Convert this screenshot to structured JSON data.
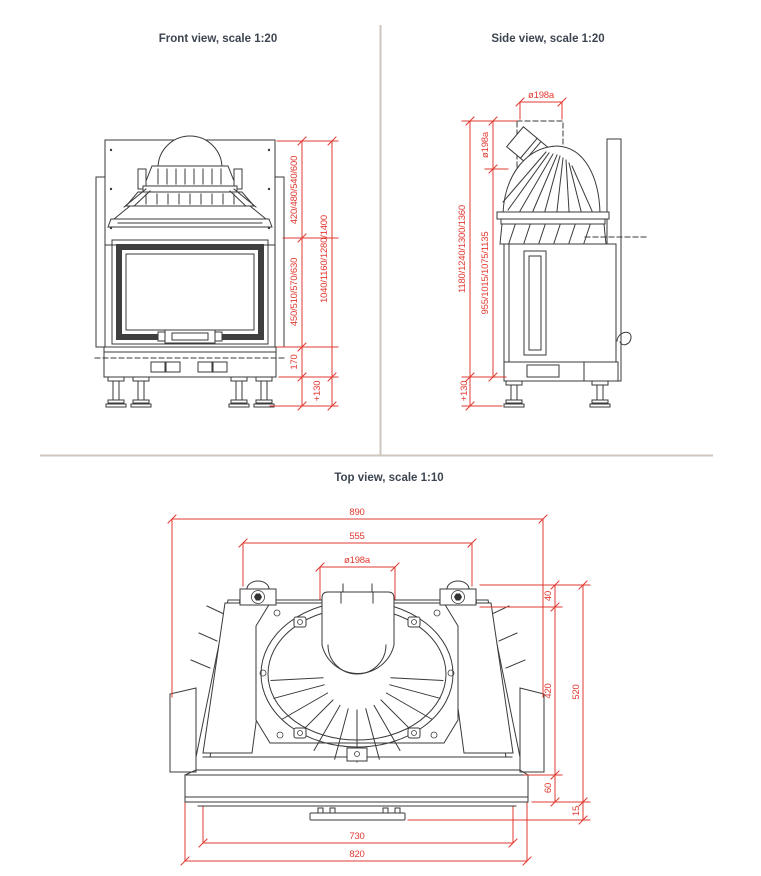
{
  "colors": {
    "dimension_red": "#e23a32",
    "drawing_line": "#3a3a3a",
    "title_text": "#3d4551",
    "divider": "#cdc6bf",
    "background": "#ffffff"
  },
  "front_view": {
    "title": "Front view, scale 1:20",
    "dims": {
      "hood_height": "420/480/540/600",
      "door_height": "450/510/570/630",
      "base_height": "170",
      "total_height": "1040/1160/1280/1400",
      "leg_height": "+130"
    }
  },
  "side_view": {
    "title": "Side view, scale 1:20",
    "dims": {
      "flue_diameter_top": "ø198a",
      "flue_diameter_side": "ø198a",
      "total_height": "1180/1240/1300/1360",
      "body_height": "955/1015/1075/1135",
      "leg_height": "+130"
    }
  },
  "top_view": {
    "title": "Top view, scale 1:10",
    "dims": {
      "overall_width": "890",
      "bracket_span": "555",
      "flue_diameter": "ø198a",
      "rear_depth": "40",
      "mid_depth": "420",
      "total_depth": "520",
      "front_depth": "60",
      "lip_depth": "15",
      "opening_width": "730",
      "base_width": "820"
    }
  }
}
